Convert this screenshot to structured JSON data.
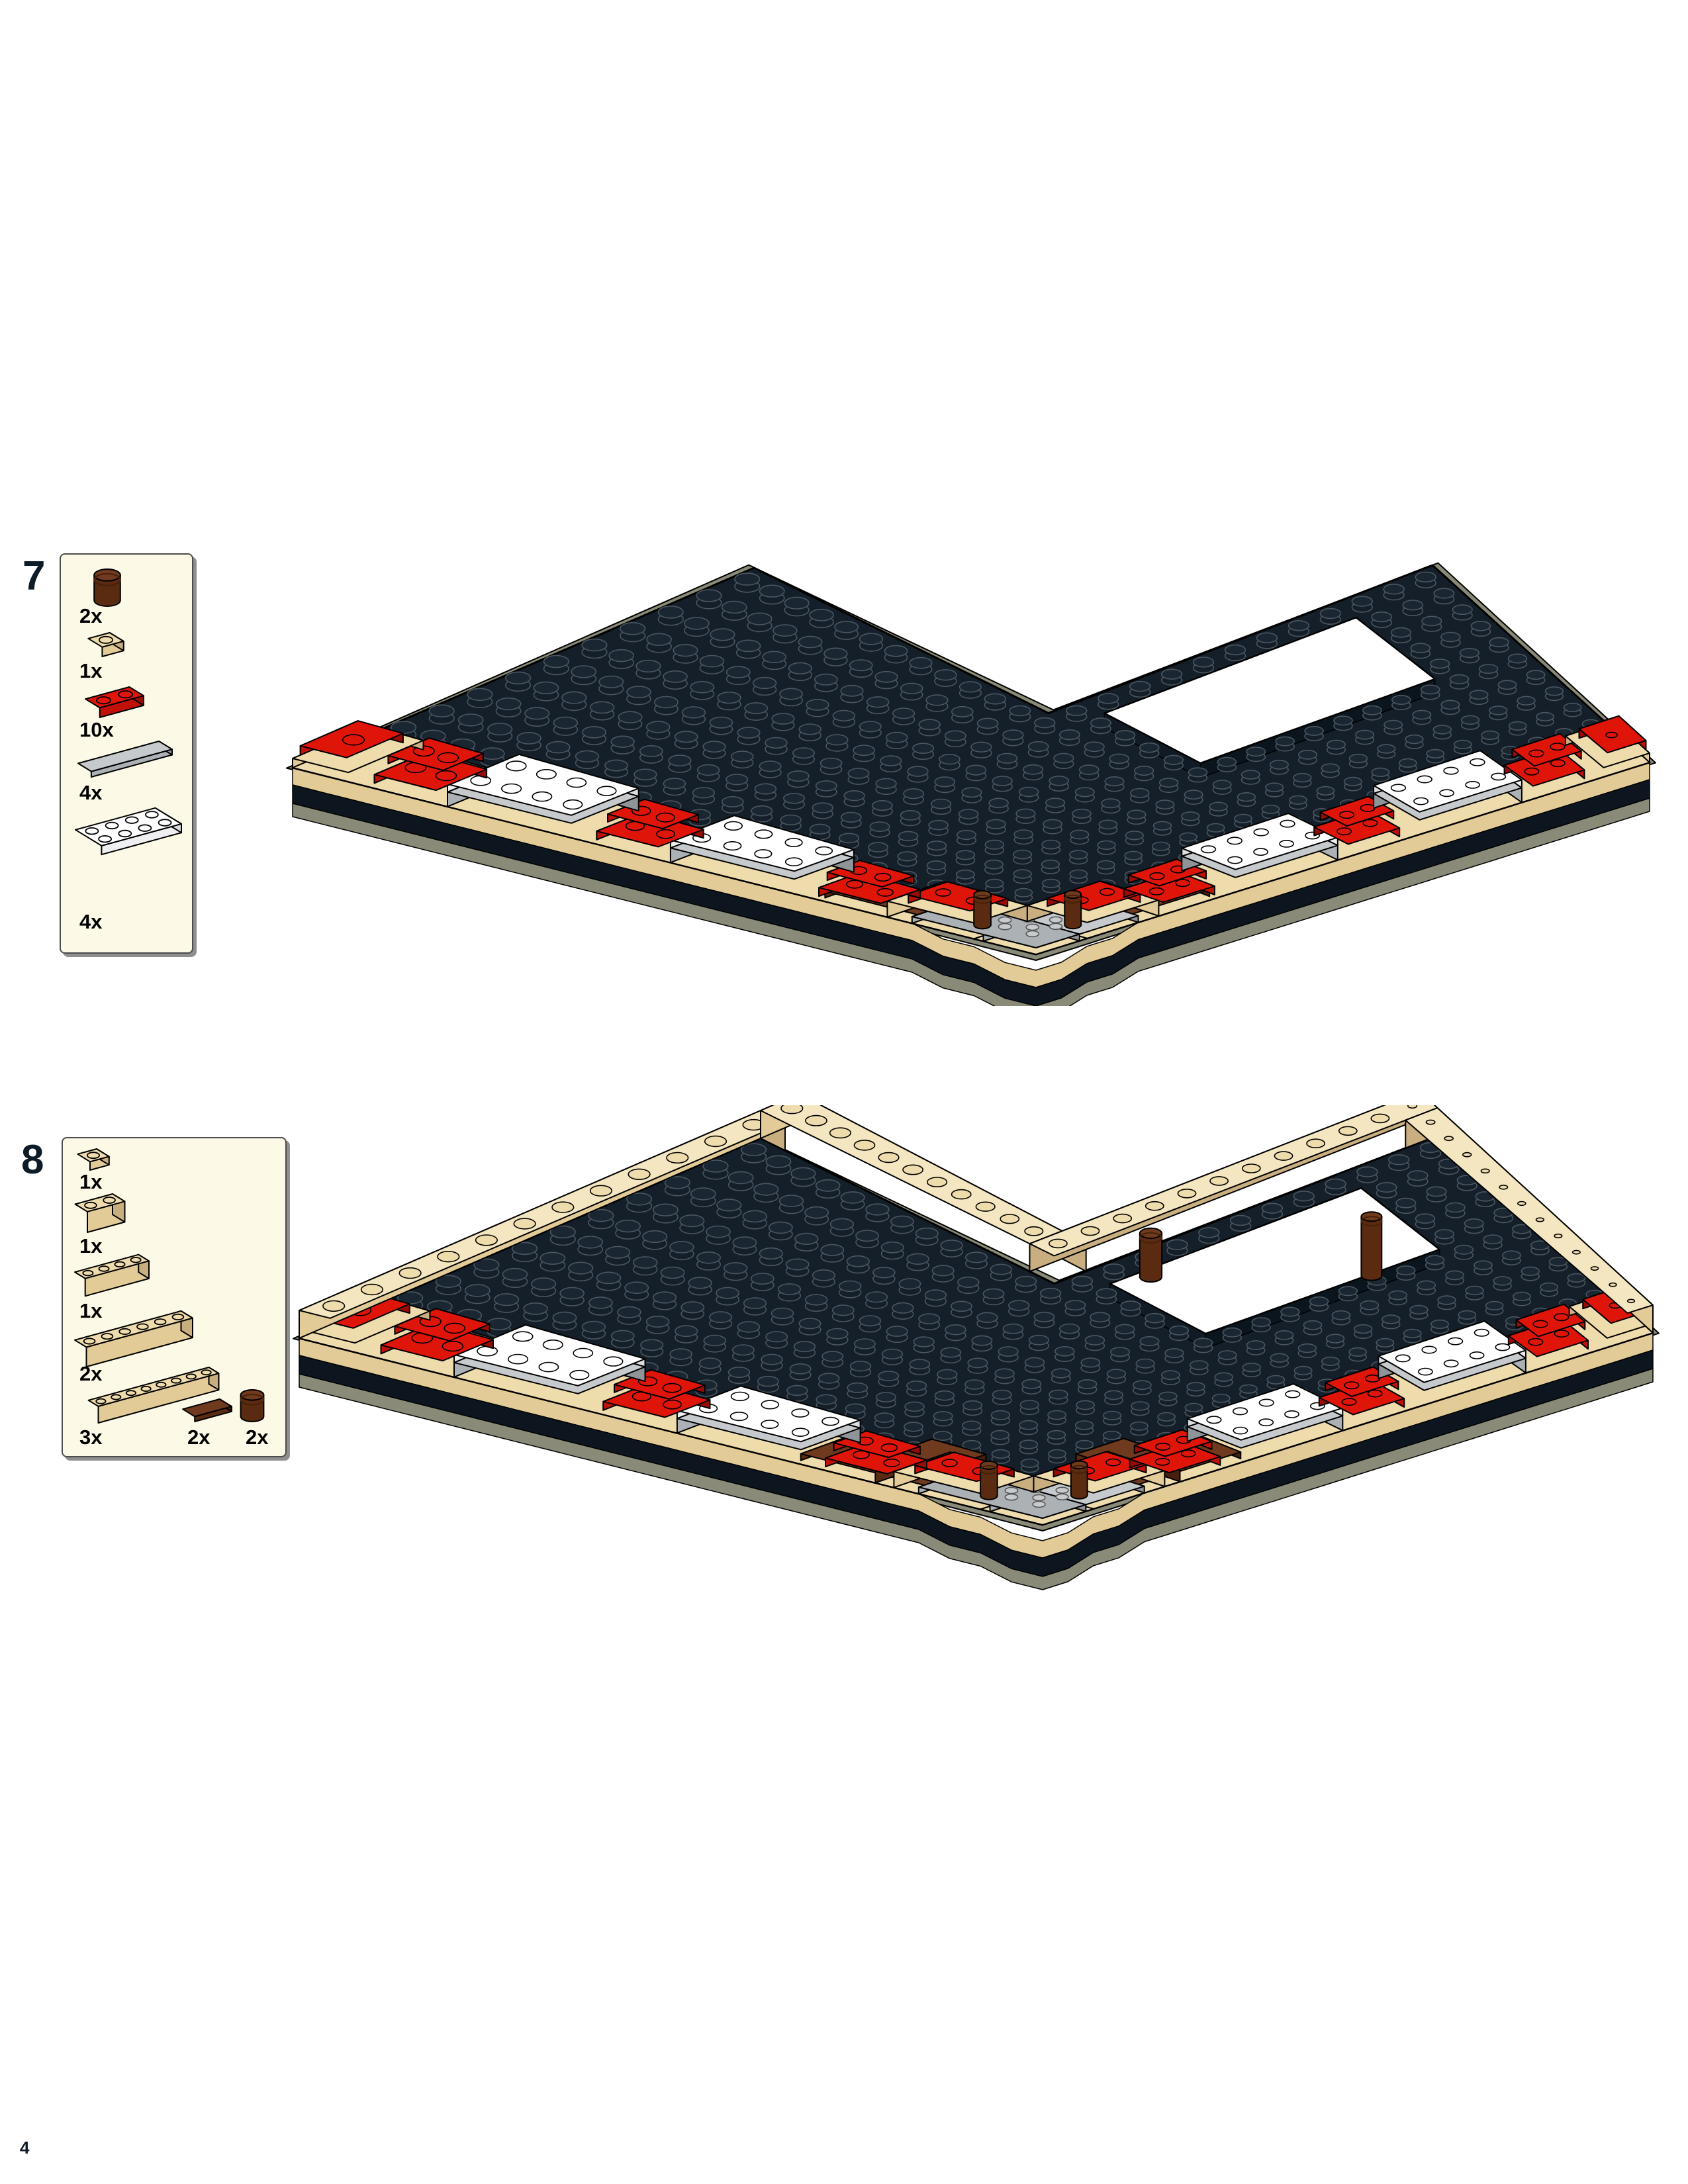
{
  "page": {
    "number": "4"
  },
  "colors": {
    "paper": "#ffffff",
    "ink": "#000000",
    "step_number": "#0E1C28",
    "callout_bg": "#FCFAE6",
    "callout_border": "#4c4c4c",
    "callout_shadow": "#8f8f8f",
    "baseplate": "#141F2A",
    "baseplate_top_stud": "#1A2631",
    "baseplate_stud_line": "#4B565F",
    "baseplate_side": "#0D161F",
    "under_olive": "#8A8A78",
    "tan": "#EFDCAD",
    "tan_top": "#F4E6C0",
    "tan_mid": "#E2CB97",
    "tan_dark": "#C9AF80",
    "red": "#E0150A",
    "red_mid": "#C11007",
    "red_dark": "#9A0B04",
    "white": "#FFFFFF",
    "white_mid": "#EFEFF1",
    "white_dark": "#DCDEE0",
    "silver": "#C6CACD",
    "silver_mid": "#ACB1B5",
    "silver_dark": "#8F9499",
    "brown": "#6F3A1D",
    "brown_mid": "#5A2B10",
    "brown_dark": "#46200A",
    "gray_stud": "#C8CBCD"
  },
  "steps": [
    {
      "number": "7",
      "parts": [
        {
          "name": "brick-1x1-round-brown",
          "qty": "2x"
        },
        {
          "name": "plate-1x1-tan",
          "qty": "1x"
        },
        {
          "name": "plate-1x2-red",
          "qty": "10x"
        },
        {
          "name": "tile-1x4-light-gray",
          "qty": "4x"
        },
        {
          "name": "plate-2x4-white",
          "qty": "4x"
        }
      ]
    },
    {
      "number": "8",
      "parts": [
        {
          "name": "plate-1x1-tan",
          "qty": "1x"
        },
        {
          "name": "brick-1x2-tan",
          "qty": "1x"
        },
        {
          "name": "brick-1x4-tan",
          "qty": "1x"
        },
        {
          "name": "brick-1x6-tan",
          "qty": "2x"
        },
        {
          "name": "brick-1x8-tan",
          "qty": "3x"
        },
        {
          "name": "tile-1x2-brown",
          "qty": "2x"
        },
        {
          "name": "brick-1x1-round-brown",
          "qty": "2x"
        }
      ]
    }
  ]
}
